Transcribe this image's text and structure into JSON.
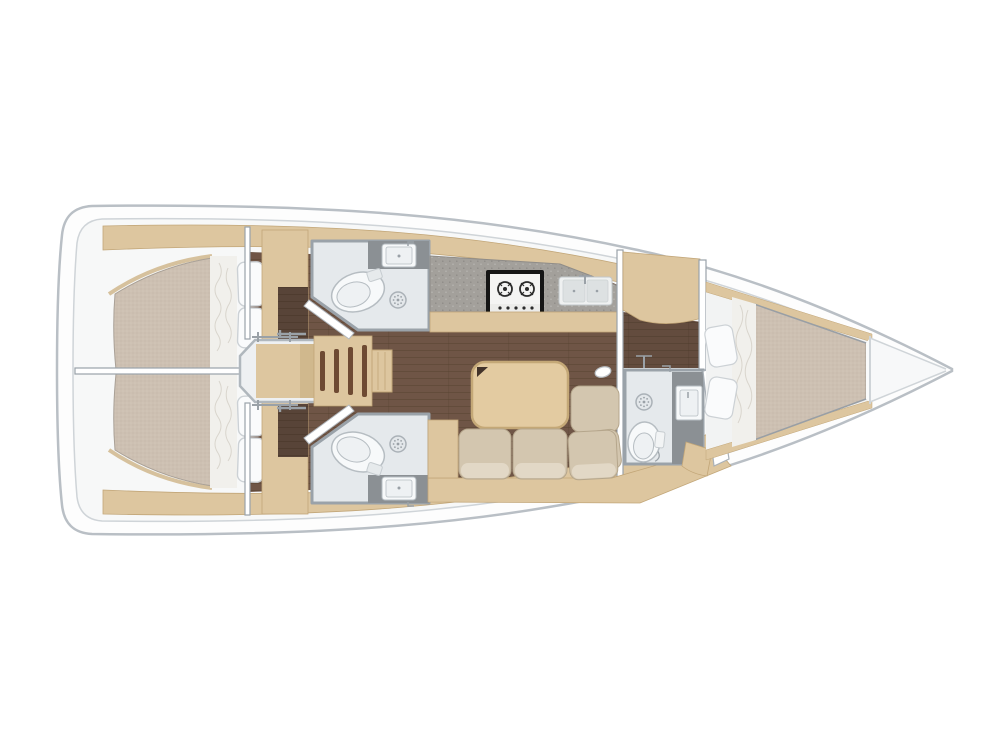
{
  "figure": {
    "kind": "Sailing yacht interior layout floor plan, top view, bow to the right",
    "orientation": "bow-right",
    "areas": {
      "aft_cabins": 2,
      "heads": 3,
      "forward_cabins": 1,
      "features": [
        "companionway-stairs",
        "galley-with-stove-and-double-sink",
        "salon-table",
        "l-shaped-sofa",
        "v-berth"
      ]
    }
  },
  "colors": {
    "bg": "#ffffff",
    "hull_fill": "#fdfdfd",
    "hull_line": "#b9bfc5",
    "deck_line": "#cfd4d8",
    "interior": "#f7f8f8",
    "wood": "#ddc69f",
    "wood_dark": "#c2a678",
    "wood_liner": "#cdb386",
    "floor": "#6f5546",
    "floor_line": "#54402f",
    "counter": "#a3a09b",
    "counter_dark": "#8b9094",
    "bath_floor": "#e5e9ec",
    "fixture_white": "#f7f9fa",
    "fixture_inner": "#eef1f3",
    "fixture_line": "#b6bdc2",
    "wall": "#9aa2a9",
    "wall_fill": "#eef0f2",
    "mattress": "#cdc0b2",
    "mattress_line": "#a9a096",
    "sheet": "#f1f0ec",
    "sheet_line": "#d9d5cd",
    "pillow": "#fafbfc",
    "pillow_line": "#ccd1d5",
    "sofa": "#d3c6af",
    "sofa_shadow": "#b5a68c",
    "sofa_light": "#e2d8c6",
    "table": "#e3cba1",
    "table_edge": "#c4a877",
    "table_notch": "#42332a",
    "stove_frame": "#151515",
    "stove_face": "#f4f4f3",
    "burner": "#2b2b2b",
    "sink": "#dde1e2",
    "sink_edge": "#cdd2d4",
    "steel": "#9aa1a7",
    "stair_tread": "#6e4a33"
  }
}
